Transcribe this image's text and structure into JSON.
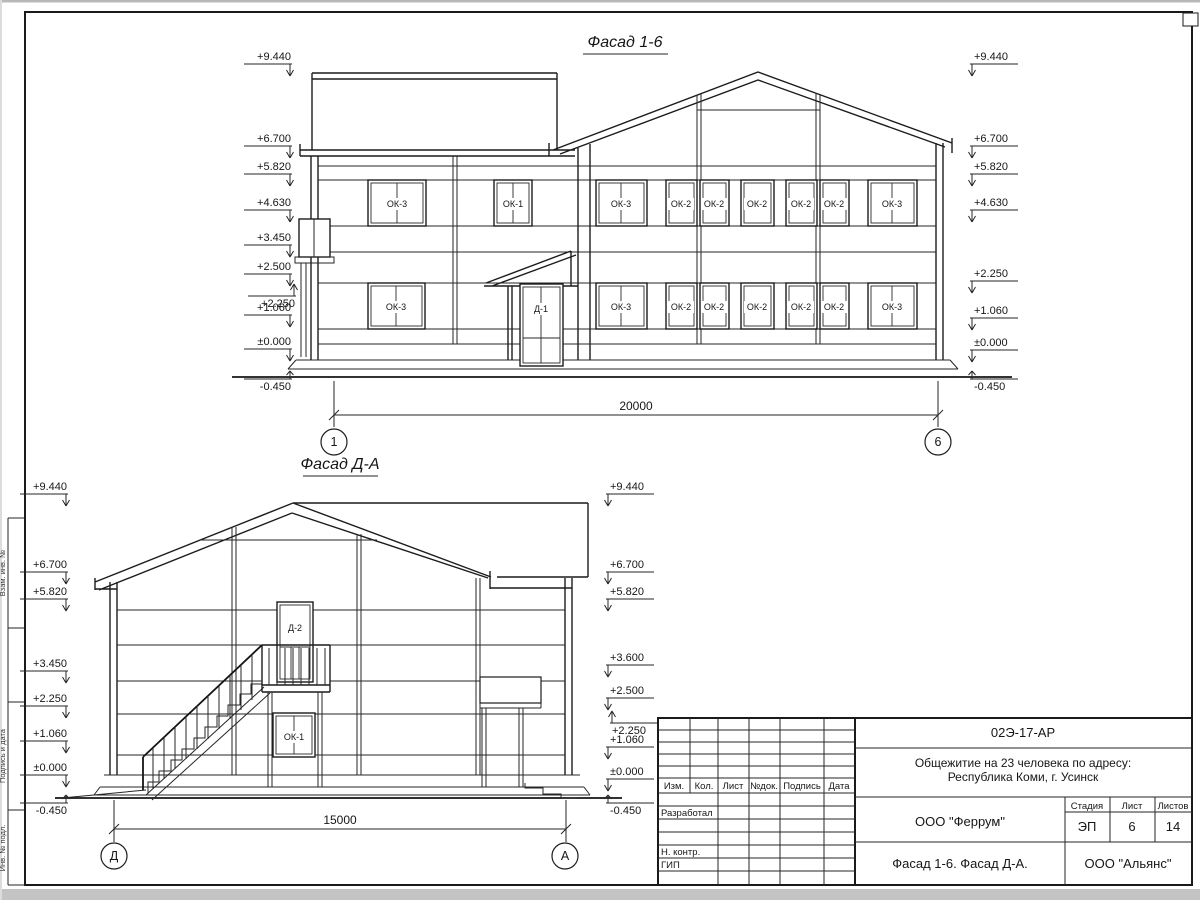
{
  "drawing": {
    "facade1": {
      "title": "Фасад 1-6",
      "dim": "20000",
      "axis_left": "1",
      "axis_right": "6",
      "marks_left": [
        "+9.440",
        "+6.700",
        "+5.820",
        "+4.630",
        "+3.450",
        "+2.500",
        "+2.250",
        "+1.060",
        "±0.000",
        "-0.450"
      ],
      "marks_right": [
        "+9.440",
        "+6.700",
        "+5.820",
        "+4.630",
        "+2.250",
        "+1.060",
        "±0.000",
        "-0.450"
      ],
      "win_upper": [
        "ОК-3",
        "ОК-1",
        "ОК-3",
        "ОК-2",
        "ОК-2",
        "ОК-2",
        "ОК-2",
        "ОК-2",
        "ОК-3"
      ],
      "win_lower": [
        "ОК-3",
        "ОК-3",
        "ОК-2",
        "ОК-2",
        "ОК-2",
        "ОК-2",
        "ОК-2",
        "ОК-3"
      ],
      "door": "Д-1"
    },
    "facade2": {
      "title": "Фасад Д-А",
      "dim": "15000",
      "axis_left": "Д",
      "axis_right": "А",
      "marks_left": [
        "+9.440",
        "+6.700",
        "+5.820",
        "+3.450",
        "+2.250",
        "+1.060",
        "±0.000",
        "-0.450"
      ],
      "marks_right": [
        "+9.440",
        "+6.700",
        "+5.820",
        "+3.600",
        "+2.500",
        "+2.250",
        "+1.060",
        "±0.000",
        "-0.450"
      ],
      "door": "Д-2",
      "window": "ОК-1"
    }
  },
  "title_block": {
    "doc_code": "02Э-17-АР",
    "project_line1": "Общежитие на 23 человека по адресу:",
    "project_line2": "Республика Коми, г. Усинск",
    "header_cells": [
      "Изм.",
      "Кол.",
      "Лист",
      "№док.",
      "Подпись",
      "Дата"
    ],
    "roles": [
      "Разработал",
      "Н. контр.",
      "ГИП"
    ],
    "org_designer": "ООО \"Феррум\"",
    "org_client": "ООО \"Альянс\"",
    "stage_label": "Стадия",
    "sheet_label": "Лист",
    "sheets_label": "Листов",
    "stage": "ЭП",
    "sheet_no": "6",
    "sheets_total": "14",
    "sheet_title": "Фасад 1-6. Фасад Д-А."
  },
  "side_labels": [
    "Взам. инв. №",
    "Подпись и дата",
    "Инв. № подл."
  ],
  "colors": {
    "paper": "#ffffff",
    "line": "#1c1c1c",
    "edge_gray": "#c4c4c4"
  }
}
